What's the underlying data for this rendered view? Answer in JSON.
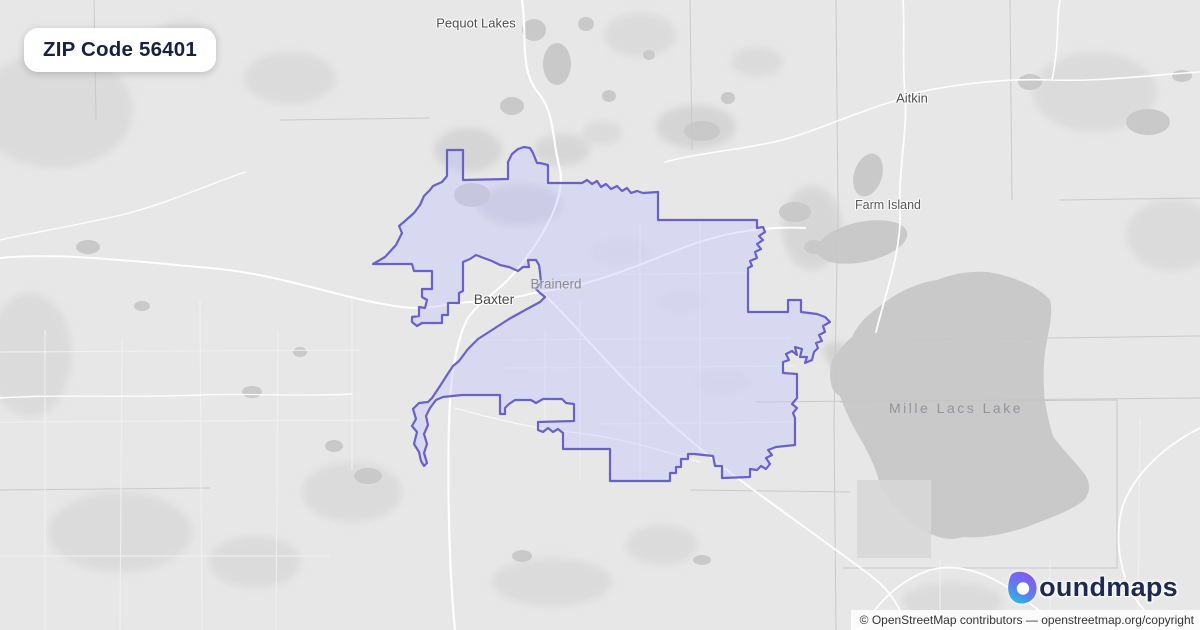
{
  "badge": {
    "title": "ZIP Code 56401"
  },
  "map": {
    "labels": {
      "pequot_lakes": "Pequot Lakes",
      "aitkin": "Aitkin",
      "farm_island": "Farm Island",
      "baxter": "Baxter",
      "brainerd": "Brainerd",
      "mille_lacs_lake": "Mille Lacs Lake"
    },
    "colors": {
      "zip_boundary": "#6a61c8",
      "zip_fill": "#c4c2ff",
      "land": "#e7e7e7",
      "water": "#c9c9c9",
      "forest": "#d9d9d9",
      "road": "#ffffff",
      "admin_line": "#c6c6c6"
    }
  },
  "logo": {
    "brand": "boundmaps",
    "wordmark_suffix": "oundmaps",
    "icon_gradient_top": "#8a55f0",
    "icon_gradient_bottom": "#1ec9df"
  },
  "attribution": {
    "contributors": "© OpenStreetMap contributors",
    "separator": " — ",
    "link": "openstreetmap.org/copyright"
  }
}
